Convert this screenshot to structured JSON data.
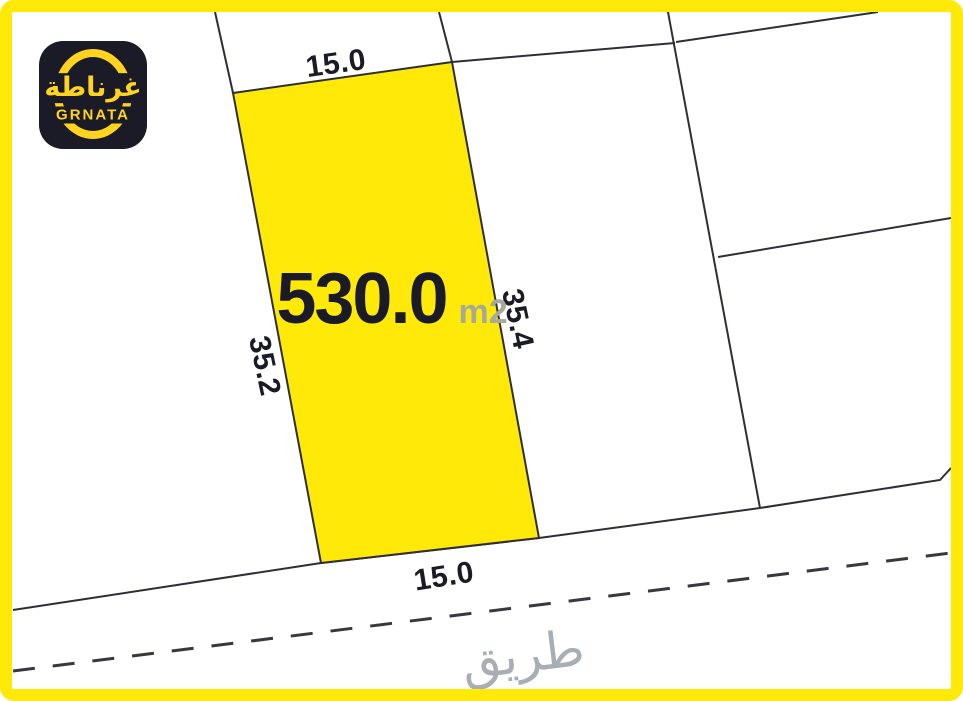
{
  "brand": {
    "logo_arabic": "غرناطة",
    "logo_latin": "GRNATA"
  },
  "plot": {
    "area_value": "530.0",
    "area_unit": "m2",
    "dimensions": {
      "top": "15.0",
      "bottom": "15.0",
      "left": "35.2",
      "right": "35.4"
    }
  },
  "road": {
    "label_arabic": "طريق"
  },
  "colors": {
    "plot_fill": "#FFE908",
    "frame": "#FFE908",
    "navy": "#1B1B27",
    "line": "#2E2E36",
    "muted": "#A9A99B",
    "road_text": "#A9AEB6",
    "logo_yellow": "#FFD41E",
    "logo_bg": "#1B1B27"
  }
}
